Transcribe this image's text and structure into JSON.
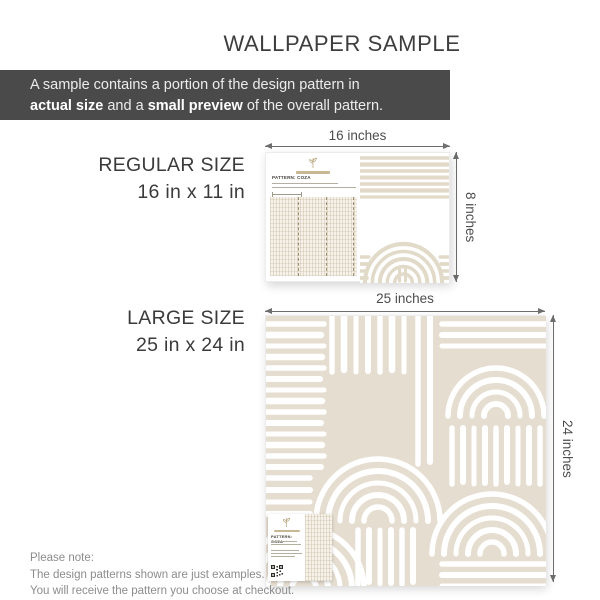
{
  "title": "WALLPAPER SAMPLE",
  "banner": {
    "line1": "A sample contains a portion of the design pattern in",
    "line2": {
      "bold1": "actual size",
      "mid": " and a ",
      "bold2": "small preview",
      "tail": " of the overall pattern."
    }
  },
  "regular_size": {
    "name": "REGULAR SIZE",
    "size": "16 in x 11 in",
    "width_label": "16 inches",
    "height_label": "8 inches",
    "card_title": "PATTERN: COZA"
  },
  "large_size": {
    "name": "LARGE SIZE",
    "size": "25 in x 24 in",
    "width_label": "25 inches",
    "height_label": "24 inches",
    "card_title": "PATTERN: COZA"
  },
  "note": {
    "line1": "Please note:",
    "line2": "The design patterns shown are just examples.",
    "line3": "You will receive the pattern you choose at checkout."
  },
  "colors": {
    "banner_bg": "#4a4a4a",
    "pattern_beige": "#e5ddcf",
    "pattern_stroke_on_white": "#e2dac8",
    "title_text": "#3e3e3e",
    "note_text": "#8c8c8c"
  }
}
